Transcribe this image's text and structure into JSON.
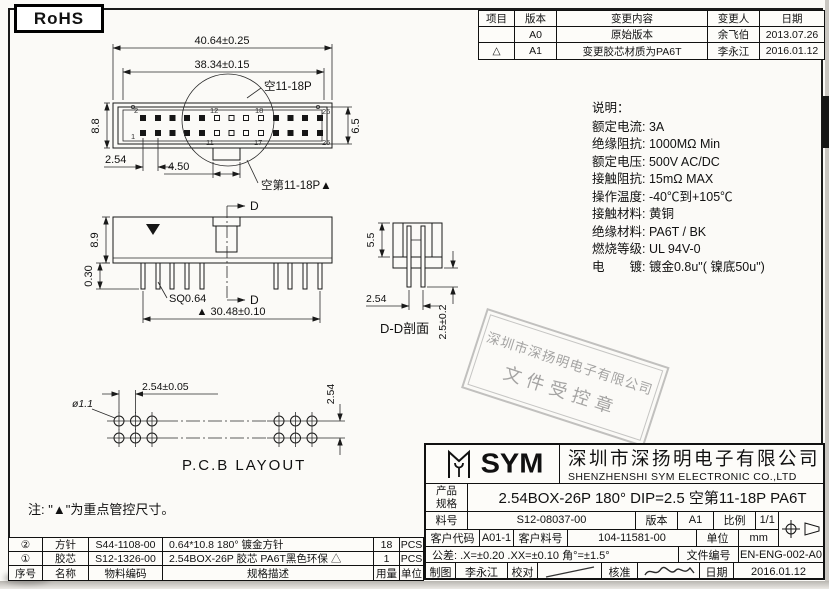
{
  "page": {
    "rohs": "RoHS",
    "note": "注: \"▲\"为重点管控尺寸。"
  },
  "colors": {
    "line": "#1a1a1a",
    "stamp_gray": "#8a8a8a"
  },
  "revision_table": {
    "headers": {
      "item": "项目",
      "version": "版本",
      "content": "变更内容",
      "person": "变更人",
      "date": "日期"
    },
    "rows": [
      {
        "item": "",
        "version": "A0",
        "content": "原始版本",
        "person": "余飞伯",
        "date": "2013.07.26"
      },
      {
        "item": "△",
        "version": "A1",
        "content": "变更胶芯材质为PA6T",
        "person": "李永江",
        "date": "2016.01.12"
      }
    ]
  },
  "specs": {
    "title": "说明：",
    "lines": [
      "额定电流: 3A",
      "绝缘阻抗: 1000MΩ Min",
      "额定电压: 500V AC/DC",
      "接触阻抗: 15mΩ MAX",
      "操作温度: -40℃到+105℃",
      "接触材料: 黄铜",
      "绝缘材料: PA6T / BK",
      "燃烧等级: UL 94V-0",
      "电　　镀: 镀金0.8u\"( 镍底50u\")"
    ]
  },
  "drawing": {
    "top_view": {
      "dim_outer_width": "40.64±0.25",
      "dim_inner_width": "38.34±0.15",
      "dim_height": "8.8",
      "dim_inner_height": "6.5",
      "dim_pitch": "2.54",
      "dim_notch": "4.50",
      "label_vacant_top": "空11-18P",
      "label_vacant_bottom": "空第11-18P▲",
      "pins": {
        "top_first": "2",
        "bottom_first": "1",
        "top_v1": "12",
        "top_v2": "18",
        "top_last": "26",
        "bottom_v1": "11",
        "bottom_v2": "17",
        "bottom_last": "25"
      }
    },
    "front_view": {
      "dim_height": "8.9",
      "dim_standoff": "0.30",
      "label_pin_sq": "SQ0.64",
      "dim_span": "▲ 30.48±0.10",
      "section_mark": "D"
    },
    "section_view": {
      "dim_depth": "5.5",
      "dim_pitch": "2.54",
      "dim_tail": "2.5±0.2",
      "label": "D-D剖面"
    },
    "pcb_view": {
      "dim_hole": "ø1.1",
      "dim_pitch": "2.54±0.05",
      "dim_row_pitch": "2.54",
      "label": "P.C.B LAYOUT"
    }
  },
  "stamp": {
    "line1": "深圳市深扬明电子有限公司",
    "line2": "文件受控章"
  },
  "title_block": {
    "logo_text": "SYM",
    "company_cn": "深圳市深扬明电子有限公司",
    "company_en": "SHENZHENSHI SYM ELECTRONIC CO.,LTD",
    "product_label_1": "产品",
    "product_label_2": "规格",
    "product_value": "2.54BOX-26P  180° DIP=2.5 空第11-18P PA6T",
    "part_no_label": "料号",
    "part_no_value": "S12-08037-00",
    "version_label": "版本",
    "version_value": "A1",
    "scale_label": "比例",
    "scale_value": "1/1",
    "customer_code_label": "客户代码",
    "customer_code_value": "A01-1",
    "customer_part_label": "客户料号",
    "customer_part_value": "104-11581-00",
    "unit_label": "单位",
    "unit_value": "mm",
    "tolerance_text": "公差: .X=±0.20  .XX=±0.10  角°=±1.5°",
    "doc_no_label": "文件编号",
    "doc_no_value": "EN-ENG-002-A0",
    "drawn_label": "制图",
    "drawn_value": "李永江",
    "check_label": "校对",
    "approve_label": "核准",
    "date_label": "日期",
    "date_value": "2016.01.12"
  },
  "bom": {
    "headers": {
      "no": "序号",
      "name": "名称",
      "code": "物料编码",
      "desc": "规格描述",
      "qty": "用量",
      "unit": "单位"
    },
    "rows": [
      {
        "no": "②",
        "name": "方针",
        "code": "S44-1108-00",
        "desc": "0.64*10.8 180° 镀金方针",
        "qty": "18",
        "unit": "PCS"
      },
      {
        "no": "①",
        "name": "胶芯",
        "code": "S12-1326-00",
        "desc": "2.54BOX-26P 胶芯 PA6T黑色环保 △",
        "qty": "1",
        "unit": "PCS"
      }
    ]
  }
}
